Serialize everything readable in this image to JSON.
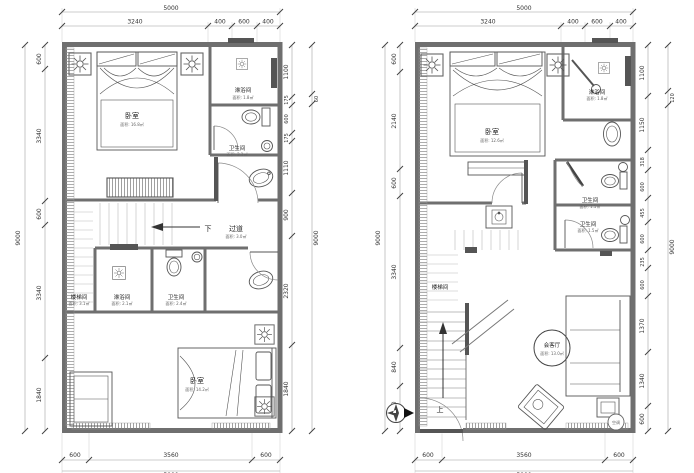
{
  "left_plan": {
    "dims": {
      "top_total": "5000",
      "top_chain": [
        "3240",
        "400",
        "600",
        "400"
      ],
      "left_total": "9000",
      "left_chain": [
        "600",
        "3340",
        "600",
        "3340",
        "1840"
      ],
      "right_chain": [
        "1100",
        "175",
        "600",
        "175",
        "1110",
        "900",
        "2320",
        "1840"
      ],
      "right_total": "9000",
      "right_offset": "60",
      "bottom_chain": [
        "600",
        "3560",
        "600"
      ],
      "bottom_total": "5000"
    },
    "rooms": {
      "bedroom_top": {
        "name": "卧室",
        "area": "面积: 16.8㎡"
      },
      "shower_top": {
        "name": "淋浴间",
        "area": "面积: 1.8㎡"
      },
      "wc_top": {
        "name": "卫生间",
        "area": "面积: 2.1㎡"
      },
      "corridor": {
        "down": "下",
        "name": "过道",
        "area": "面积: 3.0㎡"
      },
      "stairwell": {
        "name": "楼梯间",
        "area": "面积: 3.1㎡"
      },
      "shower_mid": {
        "name": "淋浴间",
        "area": "面积: 2.1㎡"
      },
      "wc_mid": {
        "name": "卫生间",
        "area": "面积: 2.4㎡"
      },
      "bedroom_bottom": {
        "name": "卧室",
        "area": "面积: 14.2㎡"
      }
    }
  },
  "right_plan": {
    "dims": {
      "top_total": "5000",
      "top_chain": [
        "3240",
        "400",
        "600",
        "400"
      ],
      "left_total": "9000",
      "left_chain": [
        "600",
        "2140",
        "600",
        "3340",
        "840",
        "1000"
      ],
      "right_chain": [
        "1100",
        "1150",
        "318",
        "600",
        "455",
        "600",
        "235",
        "600",
        "1370",
        "1340",
        "600"
      ],
      "right_total": "9000",
      "right_offset": "120",
      "bottom_chain": [
        "600",
        "3560",
        "600"
      ],
      "bottom_total": "5000"
    },
    "rooms": {
      "bedroom": {
        "name": "卧室",
        "area": "面积: 12.6㎡"
      },
      "shower": {
        "name": "淋浴间",
        "area": "面积: 1.8㎡"
      },
      "wc_top": {
        "name": "卫生间",
        "area": "面积: 1.5㎡"
      },
      "wc_bottom": {
        "name": "卫生间",
        "area": "面积: 1.5㎡"
      },
      "stairwell": {
        "name": "楼梯间"
      },
      "living": {
        "name": "会客厅",
        "area": "面积: 13.0㎡"
      },
      "up": "上",
      "ac": "空调"
    }
  },
  "colors": {
    "wall": "#6f6f6f",
    "line": "#555555",
    "dim_text": "#333333"
  }
}
